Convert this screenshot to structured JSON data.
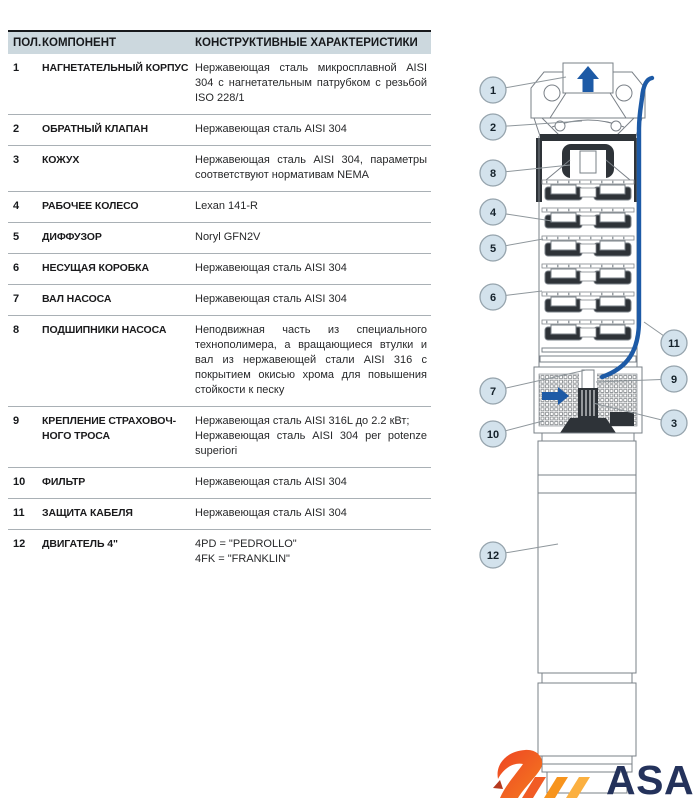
{
  "table": {
    "headers": {
      "pos": "ПОЛ.",
      "component": "КОМПОНЕНТ",
      "specs": "КОНСТРУКТИВНЫЕ ХАРАКТЕРИСТИКИ"
    },
    "rows": [
      {
        "num": "1",
        "name": "НАГНЕТАТЕЛЬНЫЙ КОРПУС",
        "desc": "Нержавеющая сталь микросплавной AISI 304 с нагнетательным патрубком с резьбой ISO 228/1"
      },
      {
        "num": "2",
        "name": "ОБРАТНЫЙ КЛАПАН",
        "desc": "Нержавеющая сталь AISI 304"
      },
      {
        "num": "3",
        "name": "КОЖУХ",
        "desc": "Нержавеющая сталь AISI 304, параметры соответствуют нормативам NEMA"
      },
      {
        "num": "4",
        "name": "РАБОЧЕЕ КОЛЕСО",
        "desc": "Lexan 141-R"
      },
      {
        "num": "5",
        "name": "ДИФФУЗОР",
        "desc": "Noryl GFN2V"
      },
      {
        "num": "6",
        "name": "НЕСУЩАЯ КОРОБКА",
        "desc": "Нержавеющая сталь AISI 304"
      },
      {
        "num": "7",
        "name": "ВАЛ НАСОСА",
        "desc": "Нержавеющая сталь AISI 304"
      },
      {
        "num": "8",
        "name": "ПОДШИПНИКИ НАСОСА",
        "desc": "Неподвижная часть из специального технополимера, а вращающиеся втулки и вал из нержавеющей стали AISI 316 с покрытием окисью хрома для повышения стойкости к песку"
      },
      {
        "num": "9",
        "name": "КРЕПЛЕНИЕ СТРАХОВОЧ-\nНОГО ТРОСА",
        "desc": "Нержавеющая сталь AISI 316L до 2.2 кВт;\nНержавеющая сталь AISI 304 per potenze superiori"
      },
      {
        "num": "10",
        "name": "ФИЛЬТР",
        "desc": "Нержавеющая сталь AISI 304"
      },
      {
        "num": "11",
        "name": "ЗАЩИТА КАБЕЛЯ",
        "desc": "Нержавеющая сталь AISI 304"
      },
      {
        "num": "12",
        "name": "ДВИГАТЕЛЬ 4\"",
        "desc": "4PD = \"PEDROLLO\"\n4FK = \"FRANKLIN\""
      }
    ]
  },
  "diagram": {
    "callouts": [
      "1",
      "2",
      "3",
      "4",
      "5",
      "6",
      "7",
      "8",
      "9",
      "10",
      "11",
      "12"
    ]
  },
  "logo": {
    "text": "ASAO"
  },
  "colors": {
    "header_band": "#ccd8de",
    "callout_fill": "#d3e2ec",
    "accent_blue": "#1d5aa6",
    "logo_navy": "#24325b",
    "logo_orange": "#f05a28"
  }
}
